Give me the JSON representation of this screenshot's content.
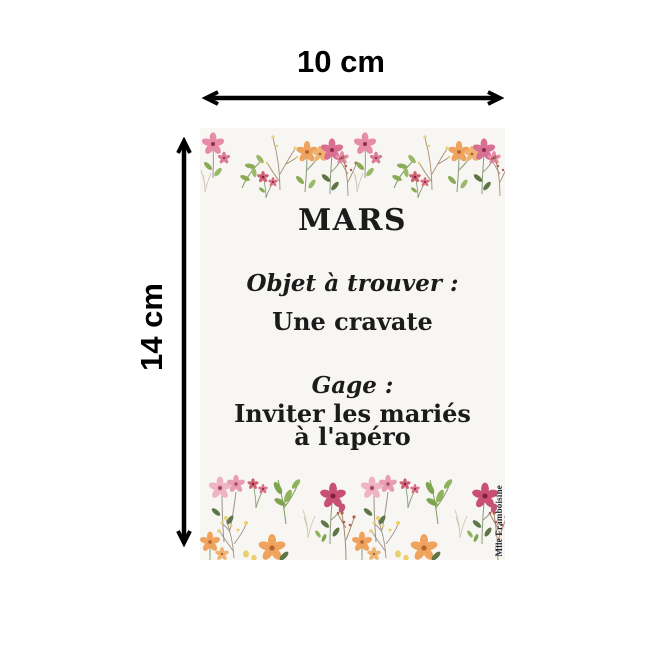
{
  "page": {
    "background": "#ffffff"
  },
  "dimension_annotations": {
    "width_label": "10 cm",
    "height_label": "14 cm",
    "arrow_color": "#000000"
  },
  "card": {
    "background": "#f7f6f3",
    "text_color": "#1b1b1b",
    "month_title": "MARS",
    "find_heading": "Objet à trouver :",
    "find_item": "Une cravate",
    "dare_heading": "Gage :",
    "dare_lines": [
      "Inviter les mariés",
      "à l'apéro"
    ],
    "watermark": "Mlle Framboisine"
  },
  "flower_palette": {
    "pink": "#e78ba8",
    "deep_pink": "#c94f75",
    "crimson": "#cf5f72",
    "light_pink": "#efb3c4",
    "flower_center_dark": "#8e2f52",
    "orange": "#efa35d",
    "orange_center": "#b5622f",
    "yellow": "#ecd06e",
    "leaf_green": "#8cab57",
    "dark_green": "#5d7547",
    "stem_gray": "#9b948a",
    "branch_tan": "#a78d6f",
    "berry": "#b06052",
    "pale_sprig": "#cdc3ad"
  }
}
